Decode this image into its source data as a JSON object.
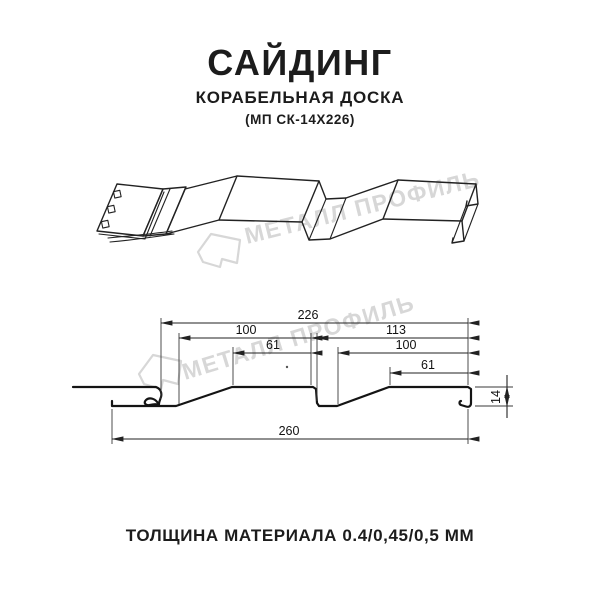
{
  "header": {
    "title": "САЙДИНГ",
    "subtitle": "КОРАБЕЛЬНАЯ ДОСКА",
    "product_code": "(МП СК-14Х226)"
  },
  "watermark": {
    "text": "МЕТАЛЛ ПРОФИЛЬ",
    "color": "#d7d7d7"
  },
  "section": {
    "dimensions": {
      "overall_width": "226",
      "left_panel_width": "100",
      "right_panel_width": "113",
      "left_flat_width": "61",
      "right_panel_inner_width": "100",
      "right_flat_width": "61",
      "total_width": "260",
      "profile_height": "14"
    }
  },
  "footer": {
    "note": "ТОЛЩИНА МАТЕРИАЛА 0.4/0,45/0,5 ММ"
  }
}
